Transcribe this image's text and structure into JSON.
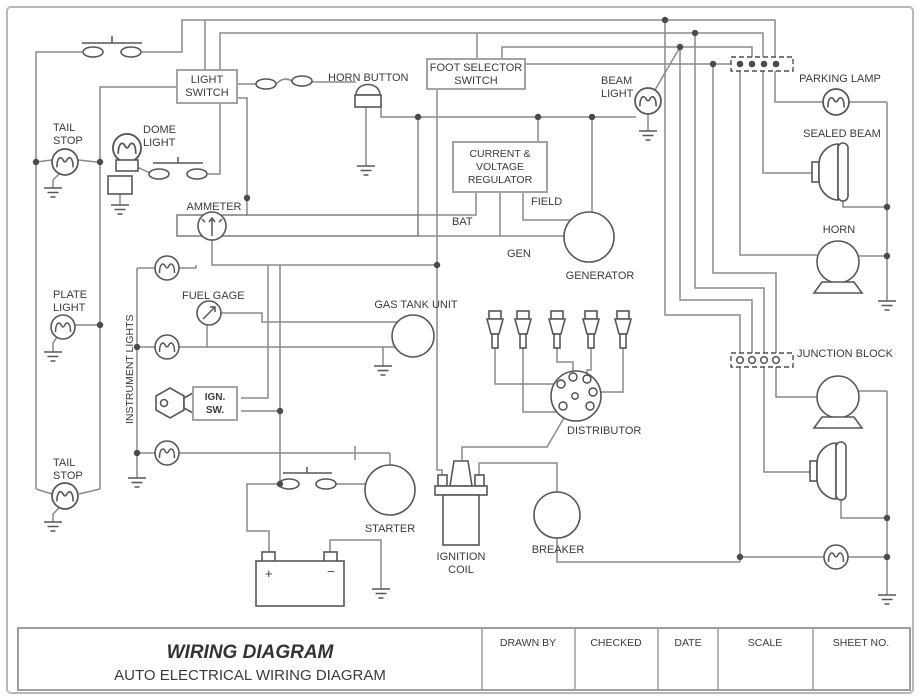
{
  "colors": {
    "wire": "#8a8a8a",
    "symbol_outline": "#575757",
    "box_border": "#a3a3a3",
    "text": "#3b3b3b",
    "page_border": "#b8b8b8"
  },
  "labels": {
    "tail_stop_top": [
      "TAIL",
      "STOP"
    ],
    "dome_light": [
      "DOME",
      "LIGHT"
    ],
    "light_switch": [
      "LIGHT",
      "SWITCH"
    ],
    "horn_button": "HORN BUTTON",
    "foot_selector_switch": [
      "FOOT SELECTOR",
      "SWITCH"
    ],
    "beam_light": [
      "BEAM",
      "LIGHT"
    ],
    "parking_lamp": "PARKING LAMP",
    "sealed_beam": "SEALED BEAM",
    "horn": "HORN",
    "current_voltage_regulator": [
      "CURRENT &",
      "VOLTAGE",
      "REGULATOR"
    ],
    "field": "FIELD",
    "bat": "BAT",
    "gen": "GEN",
    "generator": "GENERATOR",
    "ammeter": "AMMETER",
    "plate_light": [
      "PLATE",
      "LIGHT"
    ],
    "fuel_gage": "FUEL GAGE",
    "instrument_lights": "INSTRUMENT LIGHTS",
    "gas_tank_unit": "GAS TANK UNIT",
    "ign_sw": [
      "IGN.",
      "SW."
    ],
    "junction_block": "JUNCTION BLOCK",
    "distributor": "DISTRIBUTOR",
    "tail_stop_bottom": [
      "TAIL",
      "STOP"
    ],
    "starter": "STARTER",
    "ignition_coil": [
      "IGNITION",
      "COIL"
    ],
    "breaker": "BREAKER",
    "battery_plus": "+",
    "battery_minus": "−"
  },
  "title_block": {
    "title": "WIRING DIAGRAM",
    "subtitle": "AUTO ELECTRICAL WIRING DIAGRAM",
    "columns": [
      "DRAWN BY",
      "CHECKED",
      "DATE",
      "SCALE",
      "SHEET NO."
    ]
  }
}
